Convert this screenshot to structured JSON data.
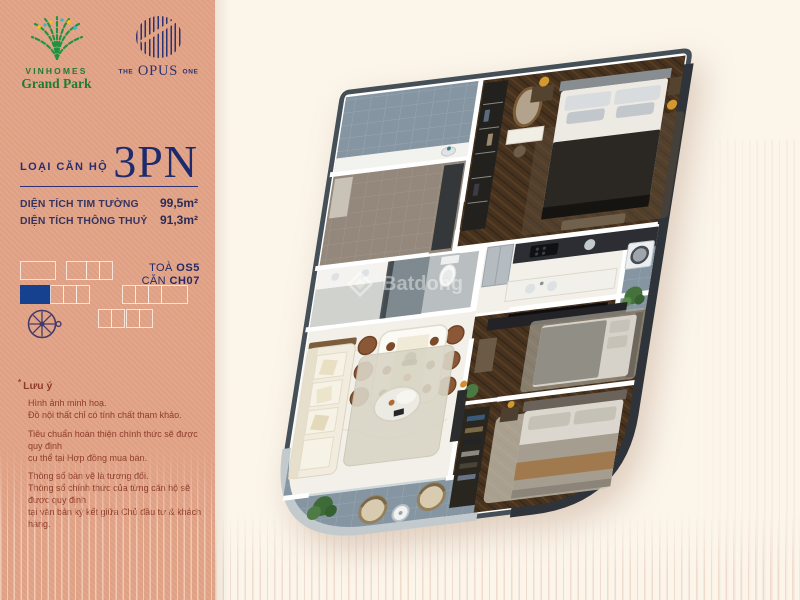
{
  "brand": {
    "vinhomes": {
      "name": "VINHOMES",
      "sub": "Grand Park"
    },
    "opus": {
      "pre": "THE",
      "main": "OPUS",
      "post": "ONE"
    }
  },
  "sidebar": {
    "unit_type_label": "LOẠI CĂN HỘ",
    "unit_type_value": "3PN",
    "areas": [
      {
        "label": "DIỆN TÍCH TIM TƯỜNG",
        "value": "99,5m²"
      },
      {
        "label": "DIỆN TÍCH THÔNG THUỶ",
        "value": "91,3m²"
      }
    ],
    "tower": {
      "label": "TOÀ",
      "value": "OS5"
    },
    "unit": {
      "label": "CĂN",
      "value": "CH07"
    },
    "keyplan": {
      "row1": [
        {
          "cls": "w-ra"
        },
        {
          "cls": "gap g-a"
        },
        {
          "cls": "w-rb"
        },
        {
          "cls": "w-sq"
        },
        {
          "cls": "w-sq"
        }
      ],
      "row2": [
        {
          "cls": "w-rc filled"
        },
        {
          "cls": "w-sq"
        },
        {
          "cls": "w-sq"
        },
        {
          "cls": "w-sq"
        },
        {
          "cls": "gap g-b"
        },
        {
          "cls": "w-sq"
        },
        {
          "cls": "w-sq"
        },
        {
          "cls": "w-sq"
        },
        {
          "cls": "w-rd"
        }
      ],
      "row3": [
        {
          "cls": "w-sq"
        },
        {
          "cls": "w-sq"
        },
        {
          "cls": "gap g-xs"
        },
        {
          "cls": "w-sq"
        },
        {
          "cls": "w-sq"
        }
      ],
      "highlight_color": "#16418e"
    },
    "notes": {
      "mark": "*",
      "title": "Lưu ý",
      "p1": "Hình ảnh minh hoạ.\nĐồ nội thất chỉ có tính chất tham khảo.",
      "p2": "Tiêu chuẩn hoàn thiện chính thức sẽ được quy định\ncụ thể tại Hợp đồng mua bán.",
      "p3": "Thông số bản vẽ là tương đối.\nThông số chính thức của từng căn hộ sẽ được quy định\ntại văn bản ký kết giữa Chủ đầu tư & khách hàng."
    }
  },
  "floorplan": {
    "watermark_text": "Batdong"
  },
  "colors": {
    "panel_pink": "#e2a386",
    "navy": "#23296b",
    "headline_navy": "#1d2b6e",
    "keyplan_blue": "#16418e",
    "note_red": "#8d3b2b",
    "cream_bg": "#fbf5ea",
    "logo_green": "#1e7a37",
    "opus_navy": "#2b3270"
  }
}
